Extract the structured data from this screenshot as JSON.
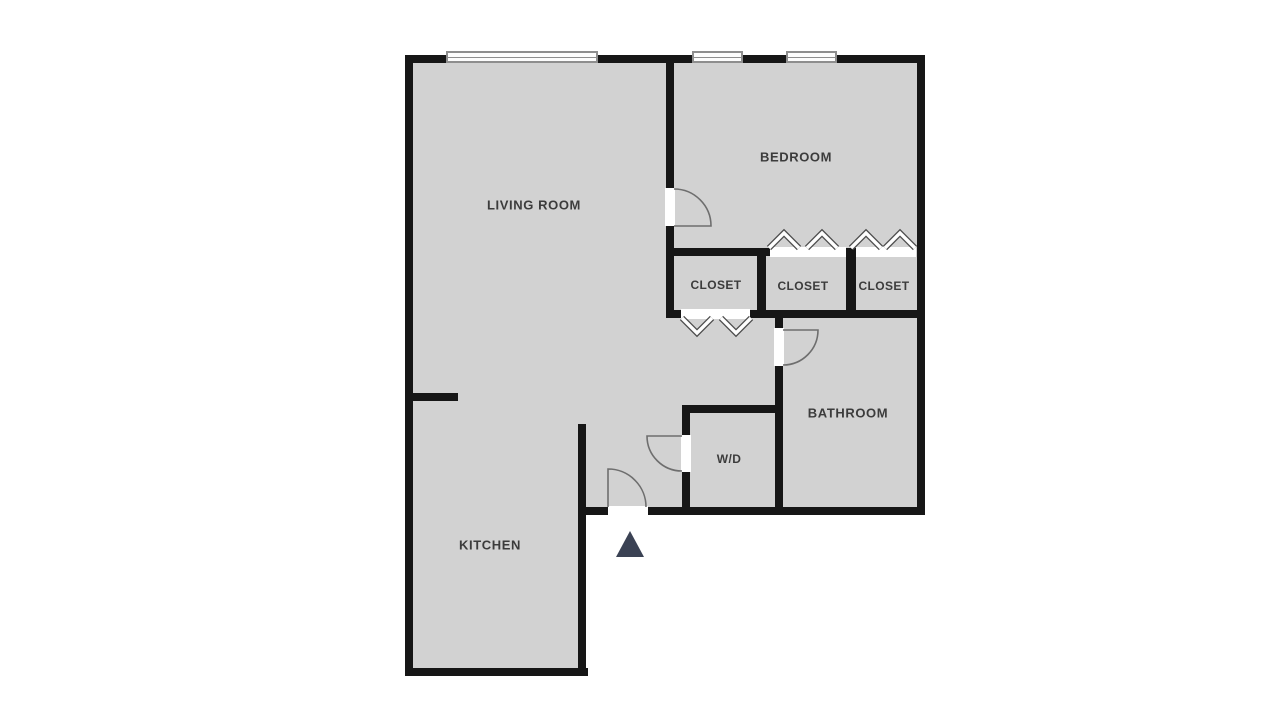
{
  "plan": {
    "type": "apartment-floor-plan",
    "rooms": {
      "living_room": "LIVING ROOM",
      "bedroom": "BEDROOM",
      "closet_1": "CLOSET",
      "closet_2": "CLOSET",
      "closet_3": "CLOSET",
      "bathroom": "BATHROOM",
      "wd": "W/D",
      "kitchen": "KITCHEN"
    },
    "features": {
      "windows": 3,
      "swing_doors": 4,
      "bifold_closet_doors": 3,
      "entry_marker": "triangle-arrow-up"
    },
    "colors": {
      "floor": "#d2d2d2",
      "wall": "#161616",
      "label_text": "#3c3c3c",
      "door_stroke": "#6e6e6e",
      "entry_arrow": "#3b4254",
      "background": "#ffffff"
    }
  }
}
